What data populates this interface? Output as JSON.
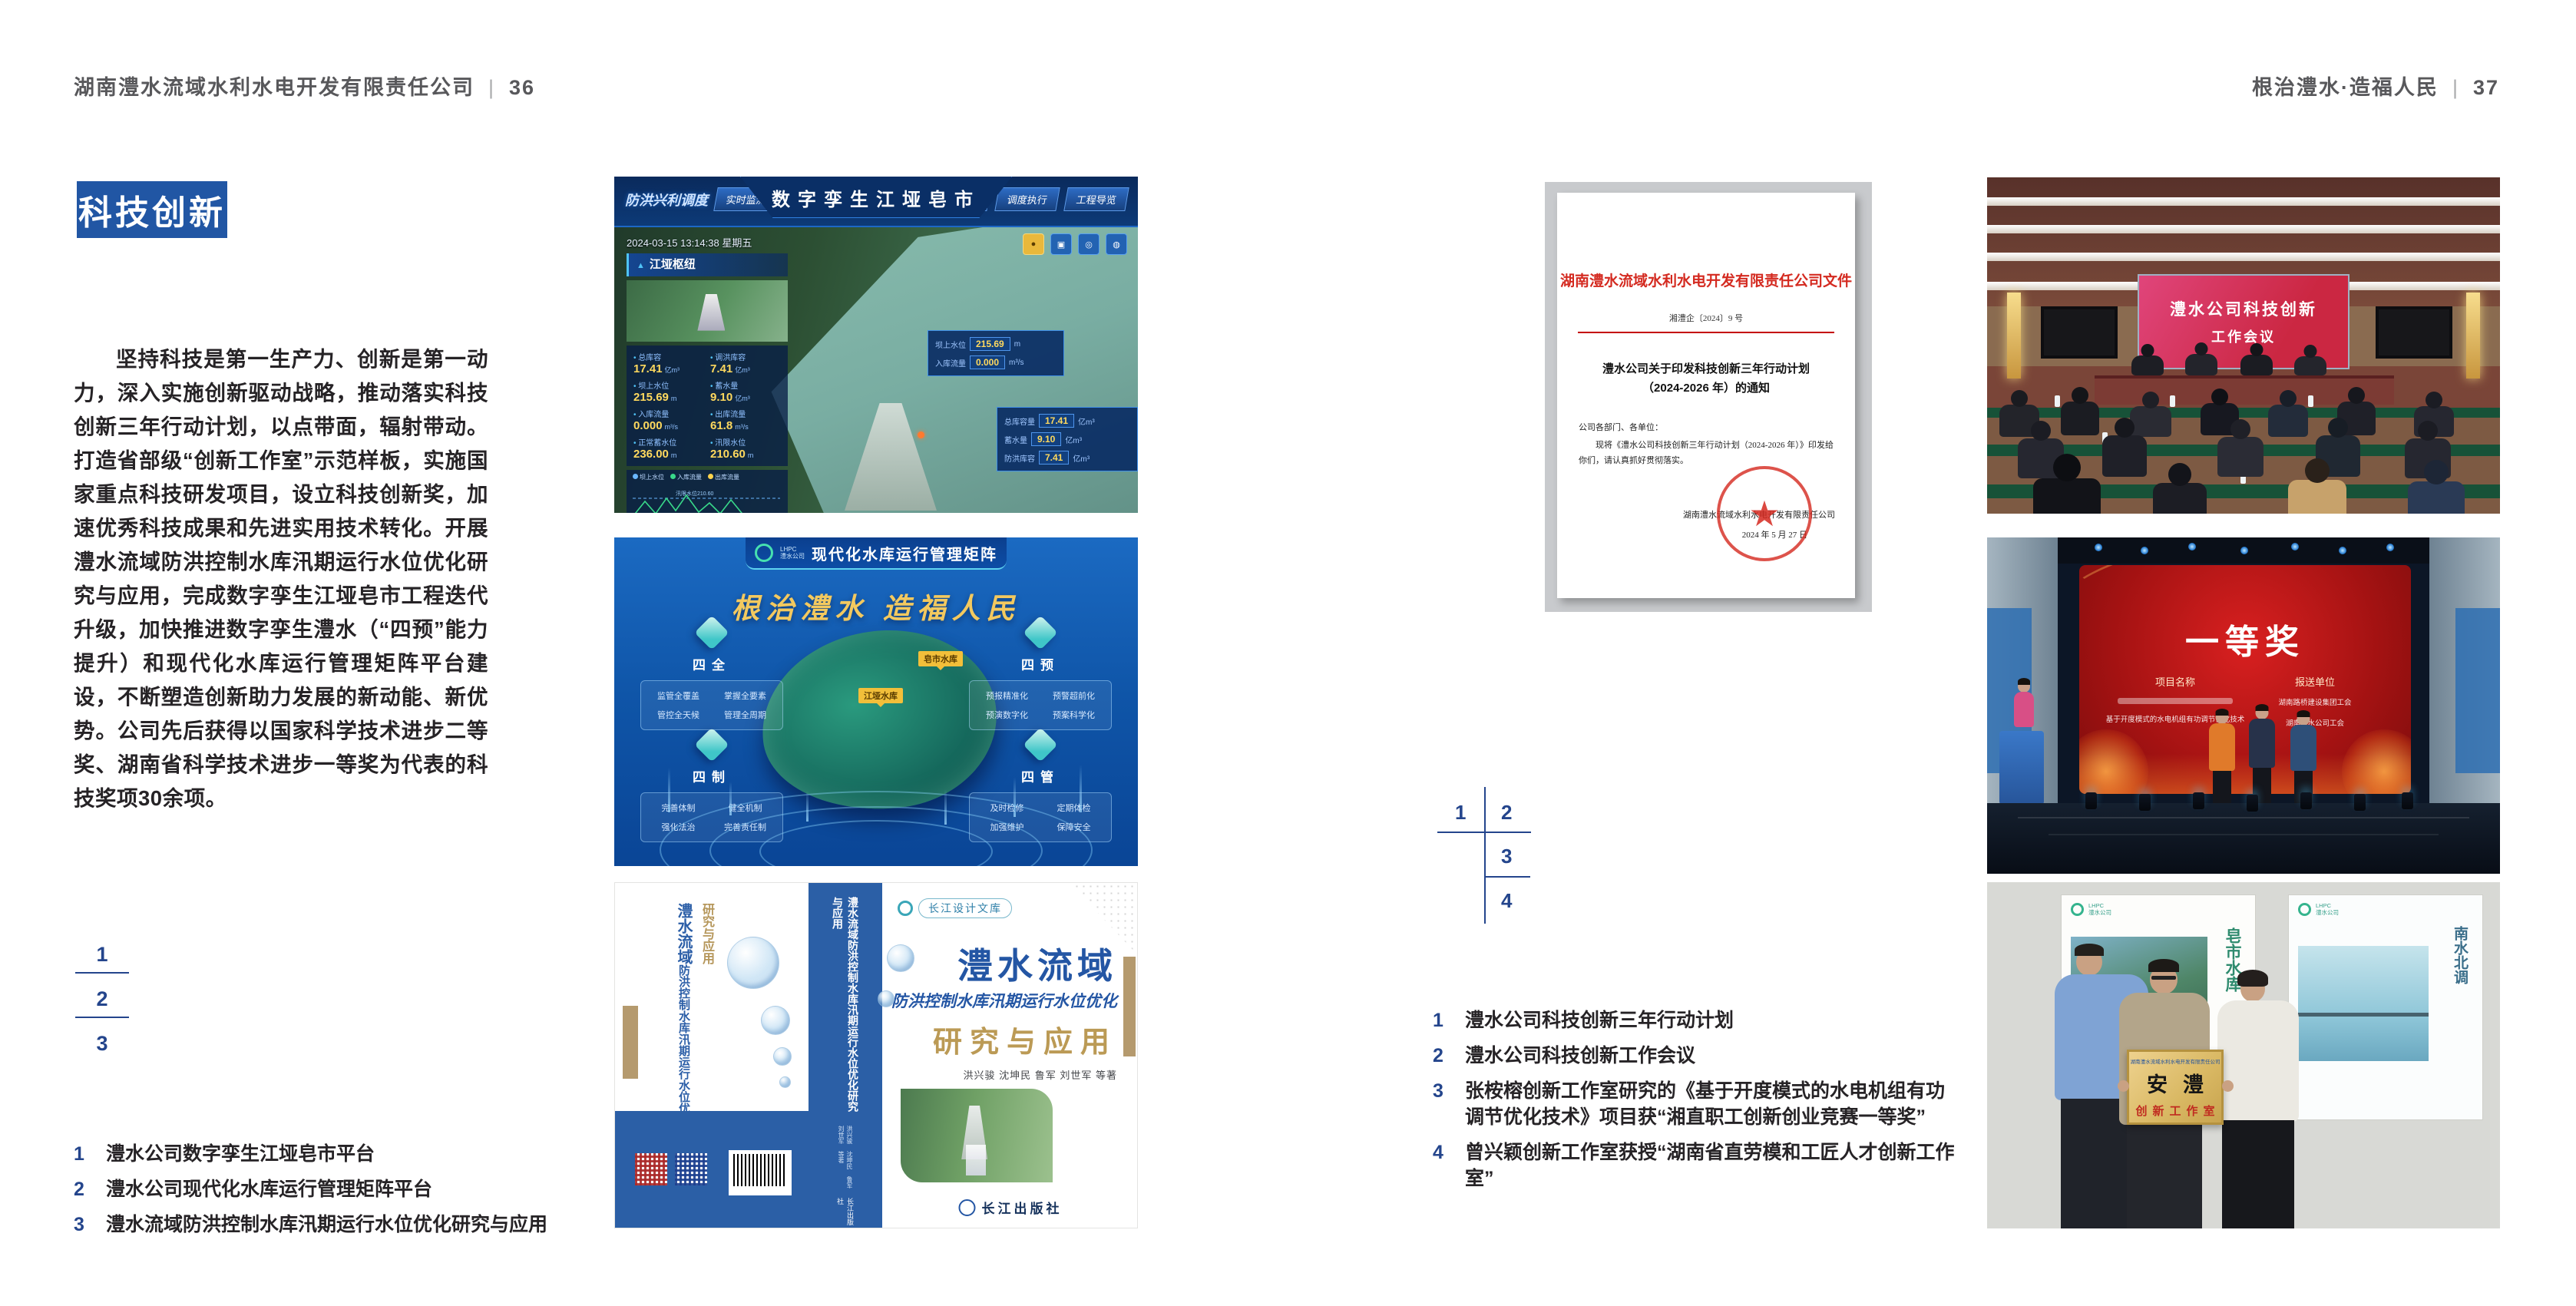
{
  "page_left": {
    "header": {
      "company": "湖南澧水流域水利水电开发有限责任公司",
      "divider": "|",
      "page_number": "36"
    },
    "badge": "科技创新",
    "paragraph": "坚持科技是第一生产力、创新是第一动力，深入实施创新驱动战略，推动落实科技创新三年行动计划，以点带面，辐射带动。打造省部级“创新工作室”示范样板，实施国家重点科技研发项目，设立科技创新奖，加速优秀科技成果和先进实用技术转化。开展澧水流域防洪控制水库汛期运行水位优化研究与应用，完成数字孪生江垭皂市工程迭代升级，加快推进数字孪生澧水（“四预”能力提升）和现代化水库运行管理矩阵平台建设，不断塑造创新助力发展的新动能、新优势。公司先后获得以国家科学技术进步二等奖、湖南省科学技术进步一等奖为代表的科技奖项30余项。",
    "figure_index": [
      "1",
      "2",
      "3"
    ],
    "captions": [
      {
        "num": "1",
        "text": "澧水公司数字孪生江垭皂市平台"
      },
      {
        "num": "2",
        "text": "澧水公司现代化水库运行管理矩阵平台"
      },
      {
        "num": "3",
        "text": "澧水流域防洪控制水库汛期运行水位优化研究与应用"
      }
    ]
  },
  "page_right": {
    "header": {
      "title": "根治澧水·造福人民",
      "divider": "|",
      "page_number": "37"
    },
    "figure_index": [
      "1",
      "2",
      "3",
      "4"
    ],
    "captions": [
      {
        "num": "1",
        "text": "澧水公司科技创新三年行动计划"
      },
      {
        "num": "2",
        "text": "澧水公司科技创新工作会议"
      },
      {
        "num": "3",
        "text": "张桉榕创新工作室研究的《基于开度模式的水电机组有功调节优化技术》项目获“湘直职工创新创业竞赛一等奖”"
      },
      {
        "num": "4",
        "text": "曾兴颖创新工作室获授“湖南省直劳模和工匠人才创新工作室”"
      }
    ]
  },
  "figures": {
    "twin": {
      "title": "数字孪生江垭皂市",
      "nav_left_label": "防洪兴利调度",
      "nav_left": [
        "实时监测",
        "洪水预报",
        "防汛预警"
      ],
      "nav_right": [
        "风险预演",
        "预案生成",
        "调度执行",
        "工程导览"
      ],
      "timestamp": "2024-03-15 13:14:38 星期五",
      "panel1_title": "江垭枢纽",
      "stats1": [
        {
          "l": "总库容",
          "v": "17.41",
          "u": "亿m³"
        },
        {
          "l": "调洪库容",
          "v": "7.41",
          "u": "亿m³"
        },
        {
          "l": "坝上水位",
          "v": "215.69",
          "u": "m"
        },
        {
          "l": "蓄水量",
          "v": "9.10",
          "u": "亿m³"
        },
        {
          "l": "入库流量",
          "v": "0.000",
          "u": "m³/s"
        },
        {
          "l": "出库流量",
          "v": "61.8",
          "u": "m³/s"
        },
        {
          "l": "正常蓄水位",
          "v": "236.00",
          "u": "m"
        },
        {
          "l": "汛限水位",
          "v": "210.60",
          "u": "m"
        }
      ],
      "legend": [
        "坝上水位",
        "入库流量",
        "出库流量"
      ],
      "chart_note": "汛限水位210.60",
      "chart_x": [
        "03-12",
        "03-13",
        "03-13",
        "03-13",
        "03-14",
        "03-14"
      ],
      "panel2_title": "江垭发电",
      "stats2": [
        {
          "l": "年发电计划",
          "v": "6.3000",
          "u": "亿度"
        },
        {
          "l": "年累计发电量",
          "v": "1.2907",
          "u": "亿度"
        },
        {
          "l": "月累计发电量",
          "v": "3259.21",
          "u": "万度"
        },
        {
          "l": "当前出力",
          "v": "0.00",
          "u": "MW"
        }
      ],
      "popup": [
        {
          "l": "坝上水位",
          "v": "215.69",
          "u": "m"
        },
        {
          "l": "入库流量",
          "v": "0.000",
          "u": "m³/s"
        }
      ],
      "sidepanel": [
        {
          "l": "总库容量",
          "v": "17.41",
          "u": "亿m³"
        },
        {
          "l": "蓄水量",
          "v": "9.10",
          "u": "亿m³"
        },
        {
          "l": "防洪库容",
          "v": "7.41",
          "u": "亿m³"
        }
      ]
    },
    "matrix": {
      "logo_top": "LHPC",
      "logo_bottom": "澧水公司",
      "title": "现代化水库运行管理矩阵",
      "slogan": "根治澧水  造福人民",
      "markers": [
        "皂市水库",
        "江垭水库"
      ],
      "groups": [
        {
          "title": "四全",
          "items": [
            "监管全覆盖",
            "掌握全要素",
            "管控全天候",
            "管理全周期"
          ]
        },
        {
          "title": "四预",
          "items": [
            "预报精准化",
            "预警超前化",
            "预演数字化",
            "预案科学化"
          ]
        },
        {
          "title": "四制",
          "items": [
            "完善体制",
            "健全机制",
            "强化法治",
            "完善责任制"
          ]
        },
        {
          "title": "四管",
          "items": [
            "及时检修",
            "定期体检",
            "加强维护",
            "保障安全"
          ]
        }
      ]
    },
    "book": {
      "series": "长江设计文库",
      "title1": "澧水流域",
      "title2": "防洪控制水库汛期运行水位优化",
      "title3": "研究与应用",
      "authors": "洪兴骏 沈坤民 鲁军 刘世军 等著",
      "spine_title": "澧水流域防洪控制水库汛期运行水位优化研究与应用",
      "publisher": "长江出版社"
    },
    "document": {
      "letterhead": "湖南澧水流域水利水电开发有限责任公司文件",
      "doc_no": "湘澧企〔2024〕9 号",
      "title": "澧水公司关于印发科技创新三年行动计划（2024-2026 年）的通知",
      "salutation": "公司各部门、各单位：",
      "body": "现将《澧水公司科技创新三年行动计划（2024-2026 年）》印发给你们，请认真抓好贯彻落实。",
      "stamp_star": "★",
      "signer": "湖南澧水流域水利水电开发有限责任公司",
      "date": "2024 年 5 月 27 日"
    },
    "meeting": {
      "screen_line1": "澧水公司科技创新",
      "screen_line2": "工作会议"
    },
    "award": {
      "title": "一等奖",
      "col1_header": "项目名称",
      "col2_header": "报送单位",
      "project2": "基于开度模式的水电机组有功调节优化技术",
      "unit1": "湖南路桥建设集团工会",
      "unit2": "湖南澧水公司工会"
    },
    "workshop": {
      "poster1_text": "皂市水库",
      "poster2_text": "南水北调",
      "plaque_org": "湖南澧水流域水利水电开发有限责任公司",
      "plaque_title": "安澧",
      "plaque_sub": "创新工作室"
    }
  }
}
